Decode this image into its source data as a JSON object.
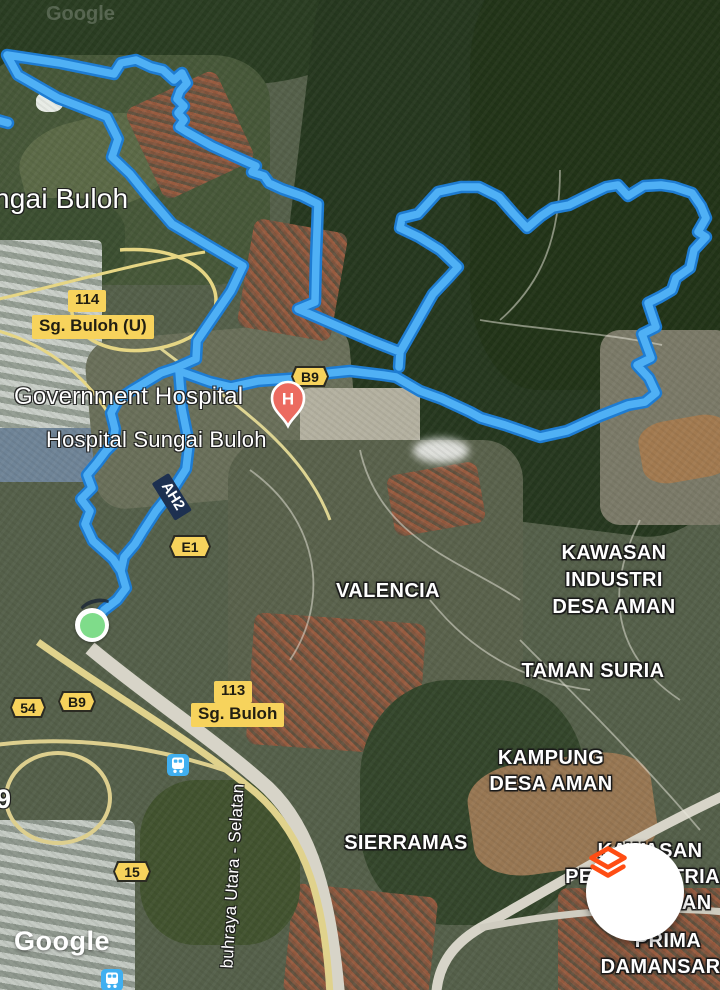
{
  "app": {
    "type": "satellite-map-activity-route-view"
  },
  "watermarks": {
    "google_logo": "Google",
    "google_ghost": "Google"
  },
  "fab": {
    "icon": "layers-icon",
    "icon_color": "#FF4D13",
    "bg": "#FFFFFF"
  },
  "route": {
    "core_color": "#4FB0F5",
    "casing_color": "#1E7CD2",
    "points": [
      [
        93,
        624
      ],
      [
        104,
        610
      ],
      [
        117,
        600
      ],
      [
        126,
        588
      ],
      [
        121,
        571
      ],
      [
        113,
        559
      ],
      [
        93,
        541
      ],
      [
        85,
        524
      ],
      [
        90,
        511
      ],
      [
        81,
        499
      ],
      [
        92,
        488
      ],
      [
        87,
        475
      ],
      [
        97,
        463
      ],
      [
        106,
        451
      ],
      [
        113,
        444
      ],
      [
        115,
        429
      ],
      [
        111,
        413
      ],
      [
        118,
        400
      ],
      [
        131,
        391
      ],
      [
        146,
        382
      ],
      [
        161,
        373
      ],
      [
        176,
        368
      ],
      [
        196,
        359
      ],
      [
        197,
        341
      ],
      [
        231,
        291
      ],
      [
        243,
        266
      ],
      [
        172,
        224
      ],
      [
        147,
        195
      ],
      [
        130,
        174
      ],
      [
        112,
        157
      ],
      [
        118,
        139
      ],
      [
        107,
        117
      ],
      [
        58,
        98
      ],
      [
        18,
        75
      ],
      [
        7,
        55
      ],
      [
        60,
        63
      ],
      [
        114,
        74
      ],
      [
        121,
        63
      ],
      [
        136,
        60
      ],
      [
        151,
        67
      ],
      [
        163,
        70
      ],
      [
        174,
        80
      ],
      [
        182,
        73
      ],
      [
        187,
        83
      ],
      [
        180,
        91
      ],
      [
        177,
        99
      ],
      [
        184,
        106
      ],
      [
        178,
        113
      ],
      [
        184,
        120
      ],
      [
        179,
        127
      ],
      [
        187,
        132
      ],
      [
        212,
        146
      ],
      [
        236,
        157
      ],
      [
        256,
        166
      ],
      [
        252,
        172
      ],
      [
        264,
        176
      ],
      [
        269,
        183
      ],
      [
        282,
        189
      ],
      [
        302,
        196
      ],
      [
        318,
        204
      ],
      [
        316,
        258
      ],
      [
        315,
        302
      ],
      [
        298,
        309
      ],
      [
        342,
        328
      ],
      [
        372,
        341
      ],
      [
        400,
        352
      ],
      [
        399,
        367
      ],
      [
        400,
        352
      ],
      [
        433,
        294
      ],
      [
        449,
        277
      ],
      [
        458,
        267
      ],
      [
        440,
        250
      ],
      [
        419,
        237
      ],
      [
        400,
        228
      ],
      [
        402,
        218
      ],
      [
        418,
        214
      ],
      [
        438,
        192
      ],
      [
        461,
        187
      ],
      [
        479,
        187
      ],
      [
        499,
        197
      ],
      [
        513,
        213
      ],
      [
        527,
        228
      ],
      [
        541,
        216
      ],
      [
        553,
        208
      ],
      [
        569,
        205
      ],
      [
        583,
        198
      ],
      [
        606,
        187
      ],
      [
        618,
        185
      ],
      [
        628,
        196
      ],
      [
        644,
        186
      ],
      [
        661,
        185
      ],
      [
        674,
        187
      ],
      [
        692,
        193
      ],
      [
        701,
        206
      ],
      [
        706,
        218
      ],
      [
        698,
        232
      ],
      [
        706,
        237
      ],
      [
        694,
        250
      ],
      [
        690,
        268
      ],
      [
        676,
        278
      ],
      [
        672,
        290
      ],
      [
        660,
        297
      ],
      [
        648,
        303
      ],
      [
        656,
        327
      ],
      [
        642,
        334
      ],
      [
        651,
        358
      ],
      [
        637,
        365
      ],
      [
        649,
        378
      ],
      [
        656,
        393
      ],
      [
        645,
        402
      ],
      [
        628,
        405
      ],
      [
        600,
        416
      ],
      [
        567,
        431
      ],
      [
        540,
        437
      ],
      [
        505,
        425
      ],
      [
        481,
        418
      ],
      [
        470,
        412
      ],
      [
        442,
        399
      ],
      [
        420,
        391
      ],
      [
        396,
        377
      ],
      [
        383,
        375
      ],
      [
        350,
        371
      ],
      [
        330,
        373
      ],
      [
        300,
        378
      ],
      [
        258,
        381
      ],
      [
        231,
        387
      ],
      [
        210,
        382
      ],
      [
        193,
        376
      ],
      [
        179,
        371
      ],
      [
        182,
        409
      ],
      [
        189,
        444
      ],
      [
        186,
        469
      ],
      [
        172,
        491
      ],
      [
        156,
        511
      ],
      [
        143,
        531
      ],
      [
        135,
        544
      ],
      [
        124,
        557
      ],
      [
        121,
        571
      ],
      [
        126,
        588
      ],
      [
        117,
        600
      ],
      [
        104,
        610
      ],
      [
        93,
        624
      ]
    ],
    "stub": [
      [
        -6,
        119
      ],
      [
        8,
        123
      ]
    ]
  },
  "markers": {
    "start": {
      "meaning": "route-start",
      "fill": "#7FDC8A",
      "ring": "#FFFFFF"
    },
    "hospital": {
      "letter": "H",
      "fill": "#EC6B60"
    }
  },
  "labels": {
    "locality": "ngai Buloh",
    "hospital1": "Government Hospital",
    "hospital2": "Hospital Sungai Buloh",
    "valencia": "VALENCIA",
    "kawasan_industri": [
      "KAWASAN",
      "INDUSTRI",
      "DESA AMAN"
    ],
    "taman_suria": "TAMAN SURIA",
    "kampung": [
      "KAMPUNG",
      "DESA AMAN"
    ],
    "sierramas": "SIERRAMAS",
    "kawasan_perindustrian": [
      "KAWASAN",
      "PERINDUSTRIAN",
      "DESA AMAN"
    ],
    "prima": [
      "PRIMA",
      "DAMANSARA"
    ],
    "highway_rotated": "buhraya Utara - Selatan",
    "nine": "9"
  },
  "badges": {
    "b114": {
      "number": "114",
      "name": "Sg. Buloh (U)"
    },
    "b113": {
      "number": "113",
      "name": "Sg. Buloh"
    },
    "b9_top": "B9",
    "b9_low": "B9",
    "e1": "E1",
    "n54": "54",
    "n15": "15",
    "ah2": "AH2"
  }
}
